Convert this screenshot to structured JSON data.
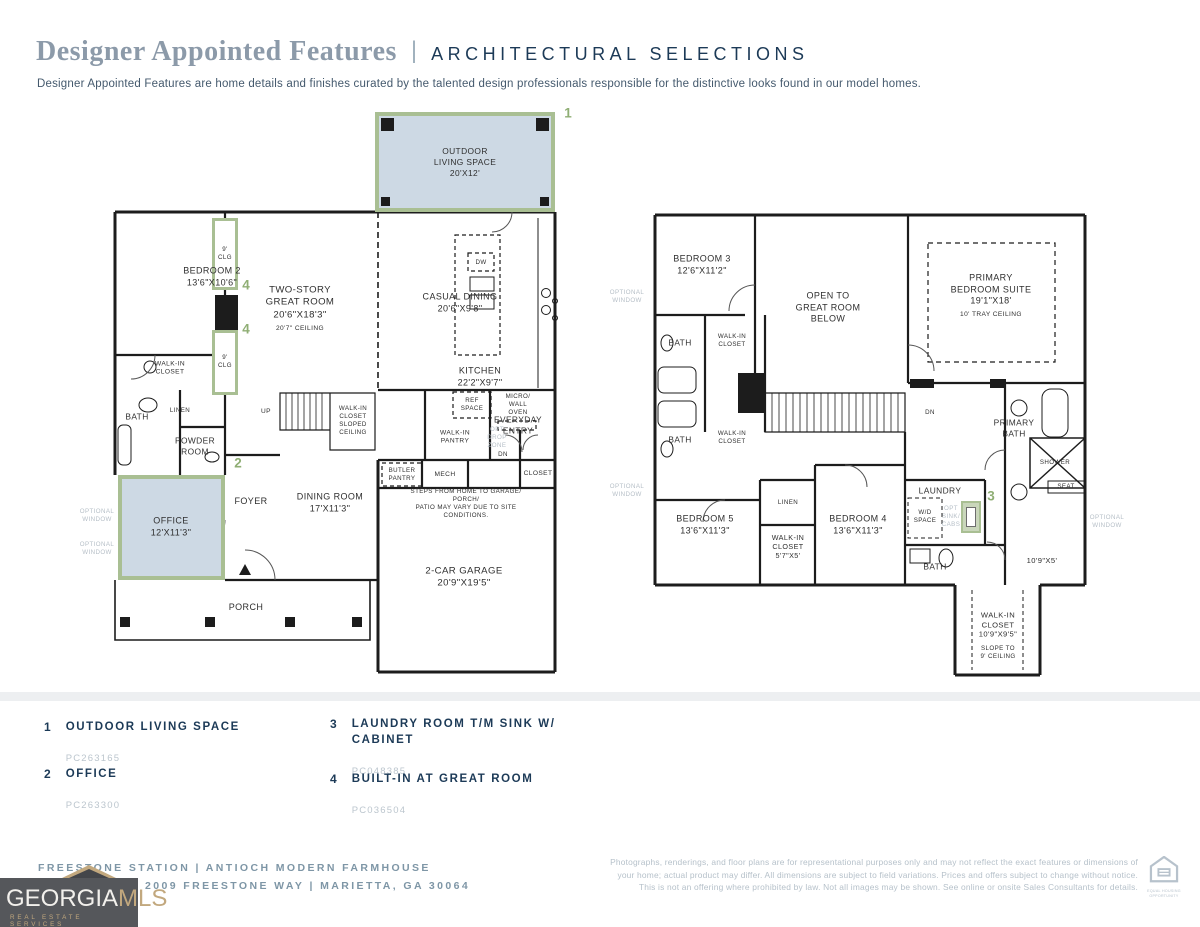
{
  "header": {
    "title": "Designer Appointed Features",
    "divider": "|",
    "section": "ARCHITECTURAL SELECTIONS",
    "description": "Designer Appointed Features are home details and finishes curated by the talented design professionals responsible for the distinctive looks found in our model homes."
  },
  "callouts": {
    "one": "1",
    "two": "2",
    "three": "3",
    "four": "4"
  },
  "floor1": {
    "labels": {
      "outdoor_living": "OUTDOOR\nLIVING SPACE\n20'X12'",
      "bedroom2": "BEDROOM 2\n13'6\"X10'6\"",
      "clg": "9'\nCLG",
      "great_room": "TWO-STORY\nGREAT ROOM\n20'6\"X18'3\"",
      "great_room_ceiling": "20'7\" CEILING",
      "casual_dining": "CASUAL DINING\n20'6\"X9'8\"",
      "kitchen": "KITCHEN\n22'2\"X9'7\"",
      "dw": "DW",
      "ref_space": "REF\nSPACE",
      "micro_wall_oven": "MICRO/\nWALL\nOVEN",
      "walk_in_closet": "WALK-IN\nCLOSET",
      "bath": "BATH",
      "linen": "LINEN",
      "powder_room": "POWDER\nROOM",
      "up": "UP",
      "wic_sloped": "WALK-IN\nCLOSET\nSLOPED\nCEILING",
      "walk_in_pantry": "WALK-IN\nPANTRY",
      "opt_drop_zone": "OPT\nDROP\nZONE",
      "everyday_entry": "EVERYDAY\nENTRY",
      "dn": "DN",
      "butler_pantry": "BUTLER\nPANTRY",
      "mech": "MECH",
      "closet": "CLOSET",
      "steps_note": "STEPS FROM HOME TO GARAGE/ PORCH/\nPATIO MAY VARY DUE TO SITE CONDITIONS.",
      "office": "OFFICE\n12'X11'3\"",
      "foyer": "FOYER",
      "dining_room": "DINING ROOM\n17'X11'3\"",
      "garage": "2-CAR GARAGE\n20'9\"X19'5\"",
      "porch": "PORCH",
      "optional_window": "OPTIONAL\nWINDOW"
    }
  },
  "floor2": {
    "labels": {
      "bedroom3": "BEDROOM 3\n12'6\"X11'2\"",
      "open_below": "OPEN TO\nGREAT ROOM\nBELOW",
      "primary_suite": "PRIMARY\nBEDROOM SUITE\n19'1\"X18'",
      "primary_suite_ceiling": "10' TRAY CEILING",
      "bath": "BATH",
      "walk_in_closet": "WALK-IN\nCLOSET",
      "dn": "DN",
      "primary_bath": "PRIMARY\nBATH",
      "shower": "SHOWER",
      "seat": "SEAT",
      "bedroom5": "BEDROOM 5\n13'6\"X11'3\"",
      "linen": "LINEN",
      "wic_5x5": "WALK-IN\nCLOSET\n5'7\"X5'",
      "bedroom4": "BEDROOM 4\n13'6\"X11'3\"",
      "laundry": "LAUNDRY",
      "wd_space": "W/D\nSPACE",
      "opt_sink": "OPT\nSINK/\nCABS",
      "hall_dim": "10'9\"X5'",
      "wic_big": "WALK-IN\nCLOSET\n10'9\"X9'5\"",
      "wic_big_slope": "SLOPE TO\n9' CEILING",
      "optional_window": "OPTIONAL\nWINDOW"
    }
  },
  "legend": {
    "items": [
      {
        "num": "1",
        "label": "OUTDOOR LIVING SPACE",
        "code": "PC263165"
      },
      {
        "num": "2",
        "label": "OFFICE",
        "code": "PC263300"
      },
      {
        "num": "3",
        "label": "LAUNDRY ROOM T/M SINK W/\nCABINET",
        "code": "PC048385"
      },
      {
        "num": "4",
        "label": "BUILT-IN AT GREAT ROOM",
        "code": "PC036504"
      }
    ]
  },
  "footer": {
    "community": "FREESTONE STATION |  ANTIOCH MODERN FARMHOUSE",
    "address": "2009 FREESTONE WAY |  MARIETTA, GA 30064",
    "logo": {
      "name_primary": "GEORGIA",
      "name_secondary": "MLS",
      "tagline": "REAL ESTATE SERVICES"
    },
    "disclaimer": "Photographs, renderings, and floor plans are for representational purposes only and may not reflect the exact features or dimensions of your home; actual product may differ. All dimensions are subject to field variations. Prices and offers subject to change without notice. This is not an offering where prohibited by law. Not all images may be shown. See online or onsite Sales Consultants for details.",
    "equal_housing": "EQUAL HOUSING\nOPPORTUNITY"
  },
  "colors": {
    "accent_green": "#8FAE74",
    "highlight_border": "#A9BF93",
    "highlight_fill": "#CDD9E4",
    "navy": "#1C3A57",
    "title_gray": "#8C9AA9",
    "muted_gray": "#B6C1CA",
    "wall": "#1C1C1C",
    "logo_bg": "#55575B",
    "logo_gold": "#C2A87E"
  }
}
